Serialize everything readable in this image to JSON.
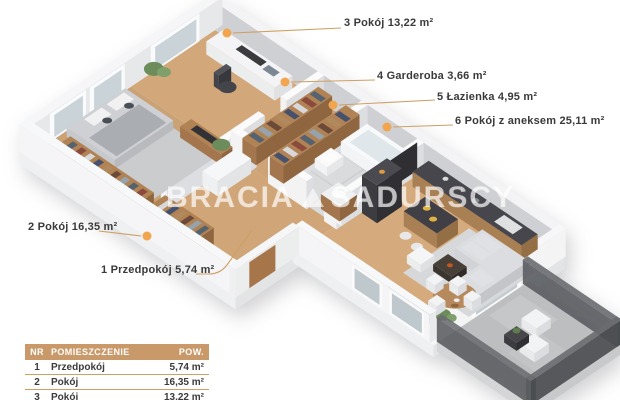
{
  "diagram": {
    "type": "isometric-floor-plan",
    "watermark": {
      "word1": "BRACIA",
      "word2": "SADURSCY"
    },
    "room_labels": [
      {
        "id": "room3",
        "text": "3 Pokój 13,22 m²"
      },
      {
        "id": "garderoba4",
        "text": "4 Garderoba 3,66 m²"
      },
      {
        "id": "lazienka5",
        "text": "5 Łazienka 4,95 m²"
      },
      {
        "id": "room6",
        "text": "6 Pokój z aneksem 25,11 m²"
      },
      {
        "id": "room2",
        "text": "2 Pokój 16,35 m²"
      },
      {
        "id": "przedpokoj1",
        "text": "1 Przedpokój 5,74 m²"
      }
    ]
  },
  "legend_table": {
    "headers": {
      "nr": "NR",
      "room": "POMIESZCZENIE",
      "area": "POW."
    },
    "rows": [
      {
        "nr": "1",
        "room": "Przedpokój",
        "area": "5,74 m²"
      },
      {
        "nr": "2",
        "room": "Pokój",
        "area": "16,35 m²"
      },
      {
        "nr": "3",
        "room": "Pokój",
        "area": "13,22 m²"
      }
    ]
  },
  "colors": {
    "accent_dot": "#f1a54e",
    "leader_line": "#cf9f63",
    "table_header_bg": "#c9996a",
    "label_text": "#3a3a3a",
    "wood_floor": "#cfa478",
    "tile_floor": "#d9dadc",
    "balcony_floor": "#bcbec0"
  }
}
